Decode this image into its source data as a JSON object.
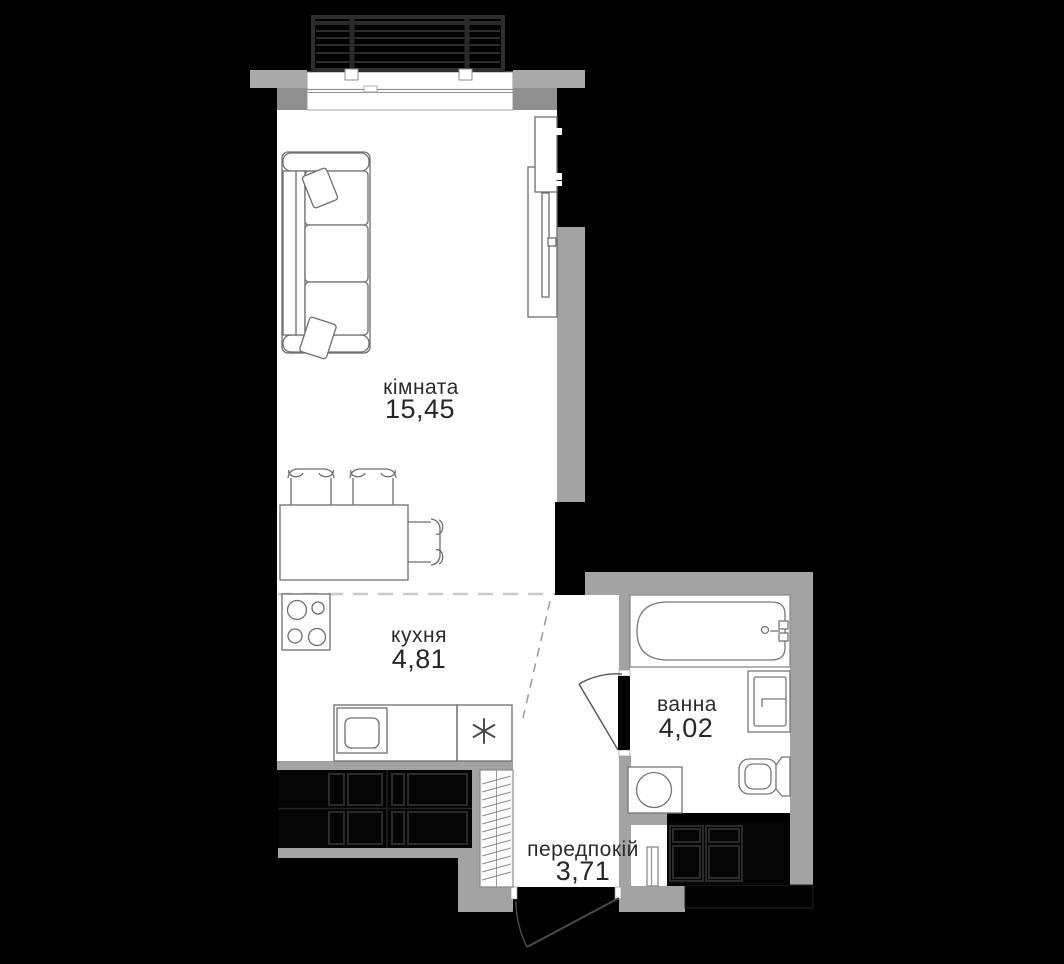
{
  "plan": {
    "title": "apartment floor plan",
    "language": "uk",
    "rooms": [
      {
        "id": "living-room",
        "name": "кімната",
        "area": "15,45"
      },
      {
        "id": "kitchen",
        "name": "кухня",
        "area": "4,81"
      },
      {
        "id": "bathroom",
        "name": "ванна",
        "area": "4,02"
      },
      {
        "id": "hallway",
        "name": "передпокій",
        "area": "3,71"
      }
    ],
    "colors": {
      "background": "#000000",
      "floor": "#ffffff",
      "wall_light_gray": "#a9a9a9",
      "wall_medium_gray": "#8f8f8f",
      "wall_black": "#000000",
      "cabinet_black": "#050505",
      "label_text": "#2b2b2b"
    },
    "fixtures": [
      "balcony-railing",
      "window",
      "sofa",
      "pillows",
      "tv-console",
      "wardrobe",
      "dining-table",
      "chairs",
      "stove",
      "kitchen-sink",
      "freezer-snowflake",
      "kitchen-cabinets",
      "hallway-wardrobe",
      "entrance-door",
      "bathroom-door",
      "bathtub",
      "washbasin",
      "toilet",
      "washing-machine",
      "built-in-closet",
      "vent-duct"
    ]
  }
}
